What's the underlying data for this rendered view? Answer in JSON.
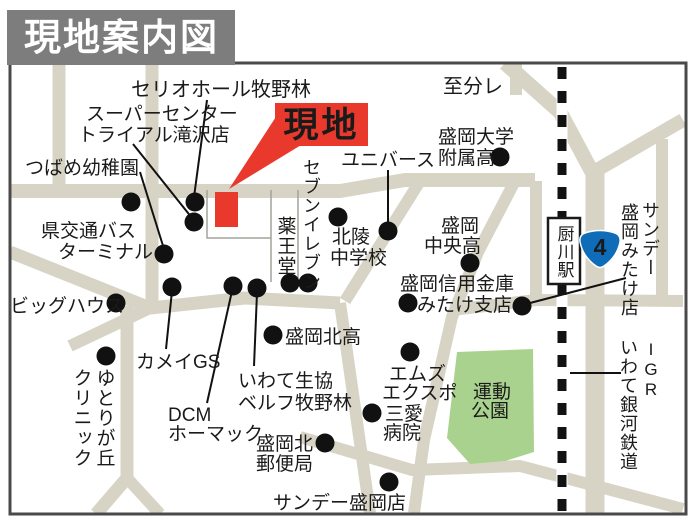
{
  "title": {
    "text": "現地案内図"
  },
  "colors": {
    "road": "#d8d4c5",
    "park_green": "#aad28f",
    "accent_red": "#e8392c",
    "header_gray": "#7d7d7d",
    "route_badge_blue": "#0e6cb8",
    "label_text": "#1a1a1a",
    "map_border": "#4a4a4a",
    "block_line": "#a3a39b",
    "railway_black": "#121212"
  },
  "site": {
    "label": "現地",
    "label_box": {
      "x": 275,
      "y": 103,
      "w": 93,
      "h": 43
    },
    "pointer_points": "229,189 283,106 306,142",
    "marker": {
      "x": 215,
      "y": 192,
      "w": 23,
      "h": 35
    }
  },
  "map": {
    "border": {
      "x": 10,
      "y": 63,
      "w": 676,
      "h": 451
    },
    "roads": [
      {
        "name": "main-road-west",
        "points": "10,191 340,191 405,180 535,180",
        "w": 14
      },
      {
        "name": "vertical-road-a",
        "points": "59,63 59,191",
        "w": 13
      },
      {
        "name": "vertical-road-b",
        "points": "152,63 152,308",
        "w": 13
      },
      {
        "name": "southwest-diagonal",
        "points": "10,252 150,308",
        "w": 13
      },
      {
        "name": "southwest-stub",
        "points": "150,308 70,346",
        "w": 12
      },
      {
        "name": "south-vertical",
        "points": "127,306 127,478 96,514",
        "w": 13
      },
      {
        "name": "south-fork",
        "points": "127,478 160,514",
        "w": 12
      },
      {
        "name": "shop-row-road",
        "points": "150,308 245,298 340,303",
        "w": 13
      },
      {
        "name": "center-diagonal-upper",
        "points": "420,181 345,301",
        "w": 12
      },
      {
        "name": "center-diagonal-lower",
        "points": "340,303 370,513",
        "w": 12
      },
      {
        "name": "park-west-road",
        "points": "516,179 478,252 452,317 424,440 414,513",
        "w": 12
      },
      {
        "name": "park-south-road",
        "points": "300,437 412,470 520,466 683,509",
        "w": 12
      },
      {
        "name": "park-north-road",
        "points": "452,310 536,300 683,301",
        "w": 12
      },
      {
        "name": "station-west-vertical",
        "points": "536,181 536,300",
        "w": 12
      },
      {
        "name": "rail-crossing-diagonal",
        "points": "505,63 560,112 592,172",
        "w": 15
      },
      {
        "name": "northeast-branch",
        "points": "590,174 683,120",
        "w": 14
      },
      {
        "name": "route4-road",
        "points": "595,170 595,514",
        "w": 19
      },
      {
        "name": "far-east-vertical",
        "points": "662,139 662,301",
        "w": 12
      },
      {
        "name": "top-right-vertical",
        "points": "516,63 516,95",
        "w": 12
      }
    ],
    "block_lines": [
      {
        "name": "site-block-outline",
        "points": "207,190 207,238 271,238"
      },
      {
        "name": "yakuodo-block-west",
        "points": "271,190 271,282"
      },
      {
        "name": "yakuodo-block-east",
        "points": "298,190 298,282"
      }
    ],
    "park": {
      "name": "sports-park",
      "points": "457,352 533,349 534,452 505,461 470,464 447,438"
    },
    "railway": {
      "x": 562,
      "y1": 63,
      "y2": 514,
      "band_w": 11,
      "dash_w": 9,
      "dash": "12 12"
    },
    "station": {
      "label": "厨川駅",
      "box": {
        "x": 548,
        "y": 218,
        "w": 32,
        "h": 66
      }
    },
    "route_badge": {
      "number": "4",
      "cx": 600,
      "cy": 249
    },
    "leader_lines": [
      {
        "name": "leader-serio-hall",
        "points": "207,100 194,197"
      },
      {
        "name": "leader-trial",
        "points": "133,144 192,218"
      },
      {
        "name": "leader-tsubame",
        "points": "140,172 164,249"
      },
      {
        "name": "leader-universe",
        "points": "388,170 388,226"
      },
      {
        "name": "leader-kamei",
        "points": "166,349 172,291"
      },
      {
        "name": "leader-dcm",
        "points": "207,403 232,291"
      },
      {
        "name": "leader-coop",
        "points": "254,366 257,293"
      },
      {
        "name": "leader-sunday-mitake",
        "points": "530,303 626,278"
      },
      {
        "name": "leader-igr",
        "points": "570,373 621,373"
      }
    ],
    "dots": [
      {
        "name": "bus-terminal",
        "x": 131,
        "y": 202
      },
      {
        "name": "serio-hall",
        "x": 195,
        "y": 202
      },
      {
        "name": "trial-takizawa",
        "x": 194,
        "y": 222
      },
      {
        "name": "tsubame-kindergarten",
        "x": 164,
        "y": 254
      },
      {
        "name": "big-house",
        "x": 116,
        "y": 303
      },
      {
        "name": "yutorigaoka-clinic",
        "x": 106,
        "y": 356
      },
      {
        "name": "kamei-gs",
        "x": 172,
        "y": 287
      },
      {
        "name": "dcm-homac",
        "x": 233,
        "y": 286
      },
      {
        "name": "iwate-coop",
        "x": 257,
        "y": 288
      },
      {
        "name": "yakuodo",
        "x": 290,
        "y": 283
      },
      {
        "name": "seven-eleven",
        "x": 308,
        "y": 283
      },
      {
        "name": "morioka-kita-high",
        "x": 273,
        "y": 335
      },
      {
        "name": "morioka-kita-post",
        "x": 325,
        "y": 443
      },
      {
        "name": "sunday-morioka",
        "x": 389,
        "y": 482
      },
      {
        "name": "sanai-hospital",
        "x": 372,
        "y": 413
      },
      {
        "name": "ms-expo",
        "x": 410,
        "y": 352
      },
      {
        "name": "hokuryo-junior-high",
        "x": 338,
        "y": 217
      },
      {
        "name": "universe",
        "x": 388,
        "y": 231
      },
      {
        "name": "morioka-chuo-high",
        "x": 470,
        "y": 263
      },
      {
        "name": "shinkin-bank",
        "x": 408,
        "y": 303
      },
      {
        "name": "sunday-mitake",
        "x": 522,
        "y": 306
      },
      {
        "name": "morioka-univ-high",
        "x": 500,
        "y": 157
      }
    ],
    "labels": [
      {
        "name": "label-serio-hall",
        "text": "セリオホール牧野林",
        "x": 131,
        "y": 96,
        "s": 20
      },
      {
        "name": "label-super-center",
        "text": "スーパーセンター",
        "x": 86,
        "y": 120,
        "s": 19
      },
      {
        "name": "label-trial-takizawa",
        "text": "トライアル滝沢店",
        "x": 78,
        "y": 141,
        "s": 19
      },
      {
        "name": "label-tsubame",
        "text": "つばめ幼稚園",
        "x": 25,
        "y": 174,
        "s": 19
      },
      {
        "name": "label-bus-terminal-1",
        "text": "県交通バス",
        "x": 41,
        "y": 237,
        "s": 19
      },
      {
        "name": "label-bus-terminal-2",
        "text": "ターミナル",
        "x": 58,
        "y": 258,
        "s": 19
      },
      {
        "name": "label-big-house",
        "text": "ビッグハウス",
        "x": 10,
        "y": 312,
        "s": 19
      },
      {
        "name": "label-kamei-gs",
        "text": "カメイGS",
        "x": 136,
        "y": 368,
        "s": 19
      },
      {
        "name": "label-dcm-1",
        "text": "DCM",
        "x": 168,
        "y": 421,
        "s": 19
      },
      {
        "name": "label-dcm-2",
        "text": "ホーマック",
        "x": 168,
        "y": 440,
        "s": 19
      },
      {
        "name": "label-coop-1",
        "text": "いわて生協",
        "x": 238,
        "y": 387,
        "s": 19
      },
      {
        "name": "label-coop-2",
        "text": "ベルフ牧野林",
        "x": 238,
        "y": 409,
        "s": 19
      },
      {
        "name": "label-kita-high",
        "text": "盛岡北高",
        "x": 285,
        "y": 343,
        "s": 19
      },
      {
        "name": "label-kita-post-1",
        "text": "盛岡北",
        "x": 256,
        "y": 450,
        "s": 19
      },
      {
        "name": "label-kita-post-2",
        "text": "郵便局",
        "x": 256,
        "y": 470,
        "s": 19
      },
      {
        "name": "label-sunday-morioka",
        "text": "サンデー盛岡店",
        "x": 273,
        "y": 509,
        "s": 19
      },
      {
        "name": "label-ms-expo-1",
        "text": "エムズ",
        "x": 389,
        "y": 380,
        "s": 19
      },
      {
        "name": "label-ms-expo-2",
        "text": "エクスポ",
        "x": 382,
        "y": 399,
        "s": 19
      },
      {
        "name": "label-sanai-1",
        "text": "三愛",
        "x": 385,
        "y": 420,
        "s": 19
      },
      {
        "name": "label-sanai-2",
        "text": "病院",
        "x": 383,
        "y": 439,
        "s": 19
      },
      {
        "name": "label-park-1",
        "text": "運動",
        "x": 473,
        "y": 398,
        "s": 19
      },
      {
        "name": "label-park-2",
        "text": "公園",
        "x": 471,
        "y": 417,
        "s": 19
      },
      {
        "name": "label-shinkin-1",
        "text": "盛岡信用金庫",
        "x": 400,
        "y": 290,
        "s": 19
      },
      {
        "name": "label-shinkin-2",
        "text": "みたけ支店",
        "x": 417,
        "y": 311,
        "s": 19
      },
      {
        "name": "label-chuo-high-1",
        "text": "盛岡",
        "x": 441,
        "y": 232,
        "s": 19
      },
      {
        "name": "label-chuo-high-2",
        "text": "中央高",
        "x": 424,
        "y": 252,
        "s": 19
      },
      {
        "name": "label-universe",
        "text": "ユニバース",
        "x": 341,
        "y": 166,
        "s": 19
      },
      {
        "name": "label-hokuryo-1",
        "text": "北陵",
        "x": 332,
        "y": 243,
        "s": 19
      },
      {
        "name": "label-hokuryo-2",
        "text": "中学校",
        "x": 330,
        "y": 264,
        "s": 19
      },
      {
        "name": "label-univ-high-1",
        "text": "盛岡大学",
        "x": 438,
        "y": 143,
        "s": 19
      },
      {
        "name": "label-univ-high-2",
        "text": "附属高",
        "x": 438,
        "y": 164,
        "s": 19
      },
      {
        "name": "label-to-wakare",
        "text": "至分レ",
        "x": 443,
        "y": 93,
        "s": 20
      },
      {
        "name": "label-yakuodo",
        "text": "薬王堂",
        "x": 285,
        "y": 216,
        "s": 19,
        "vertical": true
      },
      {
        "name": "label-seven-eleven",
        "text": "セブンイレブン",
        "x": 311,
        "y": 158,
        "s": 18,
        "vertical": true
      },
      {
        "name": "label-sunday-mitake-1",
        "text": "サンデー",
        "x": 650,
        "y": 201,
        "s": 18,
        "vertical": true
      },
      {
        "name": "label-sunday-mitake-2",
        "text": "盛岡みたけ店",
        "x": 629,
        "y": 203,
        "s": 18,
        "vertical": true
      },
      {
        "name": "label-igr-kana",
        "text": "いわて銀河鉄道",
        "x": 628,
        "y": 338,
        "s": 18,
        "vertical": true
      },
      {
        "name": "label-igr",
        "text": "IGR",
        "x": 651,
        "y": 340,
        "s": 17,
        "vertical": true
      },
      {
        "name": "label-yutorigaoka-1",
        "text": "ゆとりが丘",
        "x": 104,
        "y": 368,
        "s": 19,
        "vertical": true
      },
      {
        "name": "label-yutorigaoka-2",
        "text": "クリニック",
        "x": 81,
        "y": 368,
        "s": 19,
        "vertical": true
      }
    ]
  }
}
